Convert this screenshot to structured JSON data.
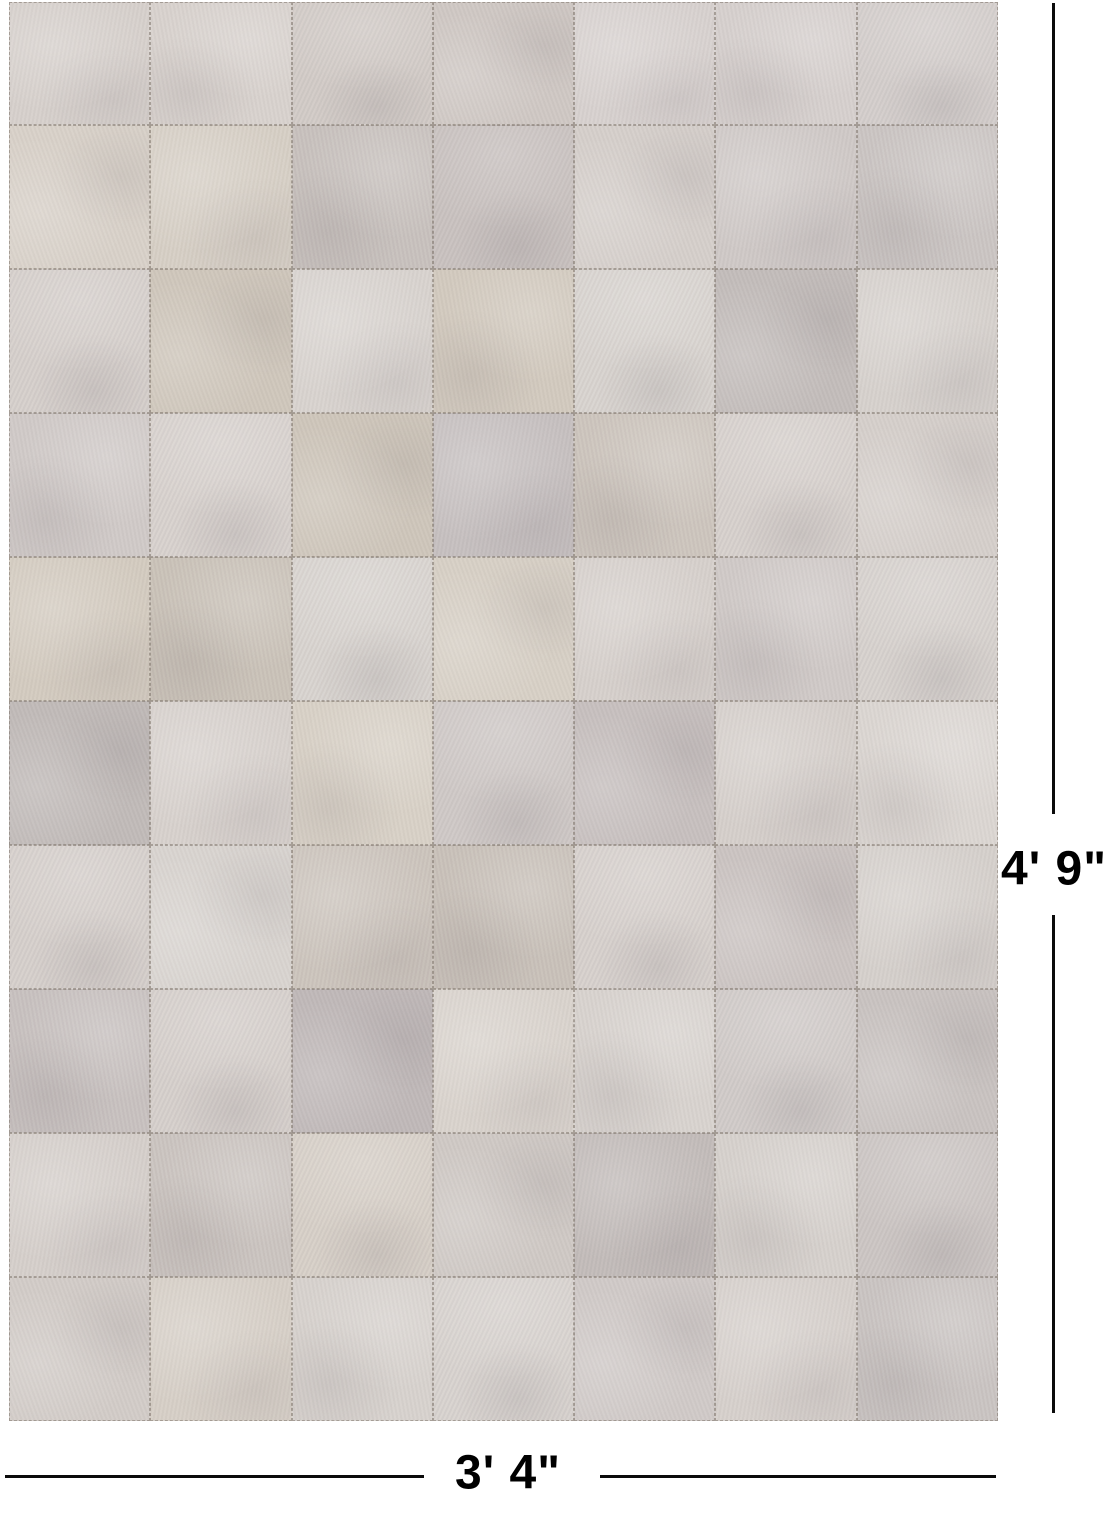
{
  "annotations": {
    "height_label": "4' 9\"",
    "width_label": "3' 4\"",
    "line_color": "#0b0b0b",
    "text_color": "#000000"
  },
  "rug": {
    "description": "patchwork-cowhide-rug",
    "rows": 10,
    "cols": 7,
    "stitch_color": "#7d7369",
    "patch_colors": [
      [
        "#d6d0cc",
        "#d8d2ce",
        "#d2cbc7",
        "#cfc8c4",
        "#d7d1cf",
        "#d6d0ce",
        "#d4cecc"
      ],
      [
        "#d8d1c9",
        "#d6cfc5",
        "#c8c1bd",
        "#c9c2c0",
        "#d5cfcb",
        "#cfc9c7",
        "#cbc5c3"
      ],
      [
        "#d6d0cc",
        "#cfc7bb",
        "#d8d3cf",
        "#d2cabe",
        "#d9d4d0",
        "#c3bcba",
        "#d6d1cd"
      ],
      [
        "#d0cac8",
        "#d8d2ce",
        "#cec6ba",
        "#c6bfbf",
        "#cdc5bd",
        "#d7d1cd",
        "#d5cfcb"
      ],
      [
        "#d3cbbf",
        "#cac2b8",
        "#d9d4d0",
        "#d7d0c6",
        "#d6d0cc",
        "#d0cac8",
        "#d7d2ce"
      ],
      [
        "#c1bab8",
        "#d7d1cd",
        "#d8d1c7",
        "#cfc9c7",
        "#c7c0be",
        "#d5cfcb",
        "#dbd6d2"
      ],
      [
        "#d6d0cc",
        "#d9d4d0",
        "#ccc4bc",
        "#c9c1b9",
        "#d7d1cd",
        "#cbc4c2",
        "#d5d0cc"
      ],
      [
        "#c8c1bf",
        "#d6d0cc",
        "#bfb8b8",
        "#d9d3cd",
        "#d8d3cf",
        "#d1cbc9",
        "#c9c3c1"
      ],
      [
        "#d5cfcb",
        "#cbc4c0",
        "#d7d0c8",
        "#cfc9c5",
        "#c2bbb9",
        "#d6d1cd",
        "#ccc6c4"
      ],
      [
        "#d2ccc8",
        "#d6cfc7",
        "#d7d2ce",
        "#d8d3cf",
        "#d0cac8",
        "#d6d0cc",
        "#cac4c2"
      ]
    ]
  }
}
